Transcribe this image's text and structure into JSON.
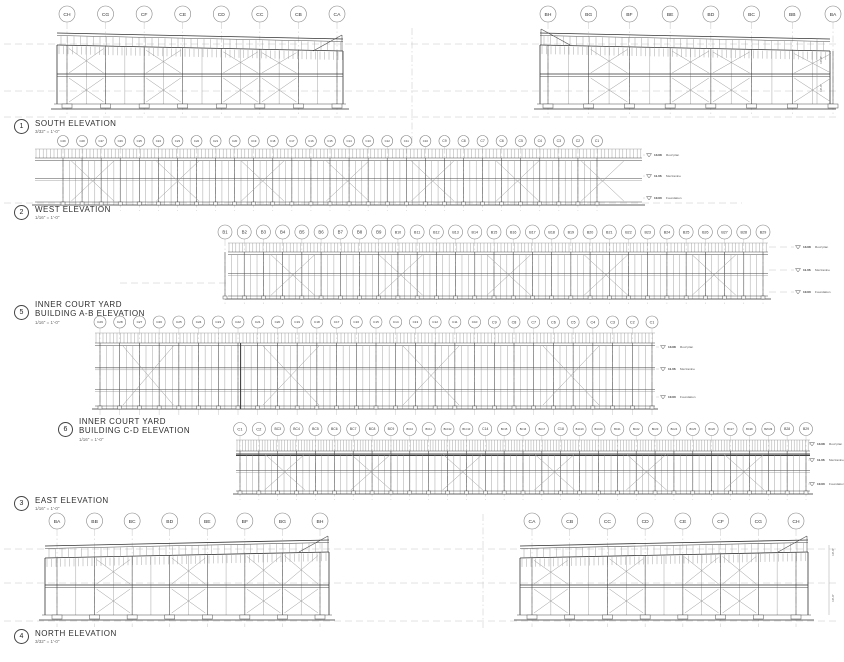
{
  "sheet": {
    "background": "#ffffff",
    "line_color": "#4a4a4a",
    "grid_color": "#b8b8b8"
  },
  "titles": [
    {
      "num": "1",
      "label": "SOUTH ELEVATION",
      "label2": "",
      "scale": "3/32\" = 1'-0\""
    },
    {
      "num": "2",
      "label": "WEST ELEVATION",
      "label2": "",
      "scale": "1/16\" = 1'-0\""
    },
    {
      "num": "5",
      "label": "INNER COURT YARD",
      "label2": "BUILDING A-B ELEVATION",
      "scale": "1/16\" = 1'-0\""
    },
    {
      "num": "6",
      "label": "INNER COURT YARD",
      "label2": "BUILDING C-D ELEVATION",
      "scale": "1/16\" = 1'-0\""
    },
    {
      "num": "3",
      "label": "EAST ELEVATION",
      "label2": "",
      "scale": "1/16\" = 1'-0\""
    },
    {
      "num": "4",
      "label": "NORTH ELEVATION",
      "label2": "",
      "scale": "3/32\" = 1'-0\""
    }
  ],
  "level_tags": [
    {
      "val": "13.08",
      "name": "Roof plan"
    },
    {
      "val": "11.06",
      "name": "Mezzanine"
    },
    {
      "val": "10.00",
      "name": "Foundation"
    }
  ],
  "datum_lines": [
    {
      "y": 44,
      "x0": 4,
      "x1": 840
    },
    {
      "y": 91,
      "x0": 4,
      "x1": 840
    },
    {
      "y": 117,
      "x0": 4,
      "x1": 840
    },
    {
      "y": 203,
      "x0": 4,
      "x1": 742
    },
    {
      "y": 283,
      "x0": 120,
      "x1": 228
    },
    {
      "y": 549,
      "x0": 4,
      "x1": 840
    },
    {
      "y": 583,
      "x0": 4,
      "x1": 840
    },
    {
      "y": 621,
      "x0": 4,
      "x1": 840
    }
  ],
  "vlines": [
    {
      "x": 412,
      "y0": 28,
      "y1": 146
    },
    {
      "x": 483,
      "y0": 514,
      "y1": 628
    }
  ],
  "elevations": [
    {
      "id": "south-building-c",
      "type": "tall",
      "high": "L",
      "gable": "R",
      "bubbles": {
        "labels": [
          "CH",
          "CG",
          "CF",
          "CE",
          "CD",
          "CC",
          "CB",
          "CA"
        ],
        "x0": 67,
        "x1": 337,
        "y": 14,
        "r": 8
      },
      "body": {
        "x": 57,
        "y": 30,
        "w": 286,
        "h": 80
      },
      "bracesU": [
        0,
        2,
        4,
        5
      ],
      "bracesL": [
        0,
        2,
        4,
        5
      ]
    },
    {
      "id": "south-building-b",
      "type": "tall",
      "high": "L",
      "gable": "L",
      "bubbles": {
        "labels": [
          "BH",
          "BG",
          "BF",
          "BE",
          "BD",
          "BC",
          "BB",
          "BA"
        ],
        "x0": 548,
        "x1": 833,
        "y": 14,
        "r": 8
      },
      "body": {
        "x": 540,
        "y": 30,
        "w": 290,
        "h": 80
      },
      "bracesU": [
        1,
        3,
        4,
        6
      ],
      "bracesL": [
        1,
        3,
        4,
        6
      ],
      "right_dims": {
        "x": 822,
        "items": [
          {
            "y": 60,
            "text": "10'-0\""
          },
          {
            "y": 88,
            "text": "10'-0\""
          }
        ]
      }
    },
    {
      "id": "west-elevation",
      "type": "long",
      "bubbles": {
        "labels": [
          "C29",
          "C28",
          "C27",
          "C26",
          "C25",
          "C24",
          "C23",
          "C22",
          "C21",
          "C20",
          "C19",
          "C18",
          "C17",
          "C16",
          "C15",
          "C14",
          "C13",
          "C12",
          "C11",
          "C10",
          "C9",
          "C8",
          "C7",
          "C6",
          "C5",
          "C4",
          "C3",
          "C2",
          "C1"
        ],
        "x0": 63,
        "x1": 597,
        "y": 141,
        "r": 5.5
      },
      "body": {
        "x": 35,
        "y": 149,
        "w": 607,
        "h": 56
      },
      "comb": 3.6,
      "combH": 9,
      "mids": [
        0.48
      ],
      "braces": [
        [
          0.06,
          0.13
        ],
        [
          0.2,
          0.27
        ],
        [
          0.34,
          0.41
        ],
        [
          0.48,
          0.55
        ],
        [
          0.62,
          0.69
        ],
        [
          0.76,
          0.83
        ],
        [
          0.9,
          0.97
        ]
      ],
      "levels": {
        "x": 649,
        "ys": [
          155,
          176,
          198
        ]
      }
    },
    {
      "id": "inner-court-yard-ab",
      "type": "long",
      "bubbles": {
        "labels": [
          "B1",
          "B2",
          "B3",
          "B4",
          "B5",
          "B6",
          "B7",
          "B8",
          "B9",
          "B10",
          "B11",
          "B12",
          "B13",
          "B14",
          "B15",
          "B16",
          "B17",
          "B18",
          "B19",
          "B20",
          "B21",
          "B22",
          "B23",
          "B24",
          "B25",
          "B26",
          "B27",
          "B28",
          "B29"
        ],
        "x0": 225,
        "x1": 763,
        "y": 232,
        "r": 7
      },
      "body": {
        "x": 228,
        "y": 243,
        "w": 540,
        "h": 56
      },
      "comb": 3.4,
      "combH": 9,
      "mids": [
        0.5
      ],
      "braces": [
        [
          0.08,
          0.16
        ],
        [
          0.28,
          0.36
        ],
        [
          0.48,
          0.56
        ],
        [
          0.66,
          0.74
        ],
        [
          0.86,
          0.94
        ]
      ],
      "levels": {
        "x": 798,
        "ys": [
          247,
          270,
          292
        ]
      }
    },
    {
      "id": "inner-court-yard-cd",
      "type": "long",
      "bubbles": {
        "labels": [
          "C29",
          "C28",
          "C27",
          "C26",
          "C25",
          "C24",
          "C23",
          "C22",
          "C21",
          "C20",
          "C19",
          "C18",
          "C17",
          "C16",
          "C15",
          "C14",
          "C13",
          "C12",
          "C11",
          "C10",
          "C9",
          "C8",
          "C7",
          "C6",
          "C5",
          "C4",
          "C3",
          "C2",
          "C1"
        ],
        "x0": 100,
        "x1": 652,
        "y": 322,
        "r": 6
      },
      "body": {
        "x": 95,
        "y": 333,
        "w": 560,
        "h": 76
      },
      "comb": 3.5,
      "combH": 10,
      "mids": [
        0.4,
        0.75
      ],
      "braces": [
        [
          0.05,
          0.14
        ],
        [
          0.3,
          0.4
        ],
        [
          0.55,
          0.65
        ],
        [
          0.8,
          0.9
        ]
      ],
      "post_heavy": [
        0.26
      ],
      "levels": {
        "x": 663,
        "ys": [
          347,
          369,
          397
        ]
      }
    },
    {
      "id": "east-elevation",
      "type": "long",
      "heavy": true,
      "bubbles": {
        "labels": [
          "C1",
          "C2",
          "BC3",
          "BC4",
          "BC5",
          "BC6",
          "BC7",
          "BC8",
          "BC9",
          "BC10",
          "BC11",
          "B1C12",
          "B1C13",
          "C14",
          "BC15",
          "BC16",
          "BC17",
          "C18",
          "B1C19",
          "B1C20",
          "BC21",
          "BC22",
          "BC23",
          "BC24",
          "BC25",
          "BC26",
          "BC27",
          "BC28",
          "B2C29",
          "B28",
          "B29"
        ],
        "x0": 240,
        "x1": 806,
        "y": 429,
        "r": 6.5
      },
      "body": {
        "x": 236,
        "y": 440,
        "w": 574,
        "h": 54
      },
      "comb": 2.8,
      "combH": 11,
      "mids": [
        0.5
      ],
      "braces": [
        [
          0.05,
          0.12
        ],
        [
          0.2,
          0.27
        ],
        [
          0.36,
          0.43
        ],
        [
          0.52,
          0.59
        ],
        [
          0.68,
          0.75
        ],
        [
          0.85,
          0.92
        ]
      ],
      "levels": {
        "x": 812,
        "ys": [
          444,
          460,
          484
        ]
      }
    },
    {
      "id": "north-building-b",
      "type": "tall",
      "high": "R",
      "gable": "R",
      "bubbles": {
        "labels": [
          "BA",
          "BB",
          "BC",
          "BD",
          "BE",
          "BF",
          "BG",
          "BH"
        ],
        "x0": 57,
        "x1": 320,
        "y": 521,
        "r": 8
      },
      "body": {
        "x": 45,
        "y": 537,
        "w": 284,
        "h": 84
      },
      "bracesU": [
        1,
        3,
        5,
        6
      ],
      "bracesL": [
        1,
        3,
        5,
        6
      ]
    },
    {
      "id": "north-building-c",
      "type": "tall",
      "high": "R",
      "gable": "R",
      "bubbles": {
        "labels": [
          "CA",
          "CB",
          "CC",
          "CD",
          "CE",
          "CF",
          "CG",
          "CH"
        ],
        "x0": 532,
        "x1": 796,
        "y": 521,
        "r": 8
      },
      "body": {
        "x": 520,
        "y": 537,
        "w": 288,
        "h": 84
      },
      "bracesU": [
        0,
        2,
        4,
        5
      ],
      "bracesL": [
        0,
        2,
        4,
        5
      ],
      "right_dims": {
        "x": 834,
        "items": [
          {
            "y": 552,
            "text": "10'-0\""
          },
          {
            "y": 598,
            "text": "10'-0\""
          }
        ]
      }
    }
  ]
}
